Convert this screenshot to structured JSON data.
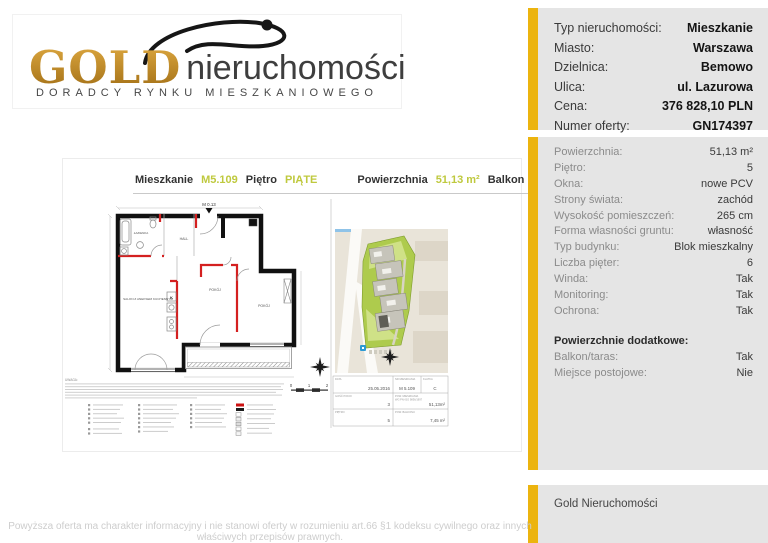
{
  "page": {
    "footer_disclaimer": "Powyższa oferta ma charakter informacyjny i nie stanowi oferty w rozumieniu art.66 §1 kodeksu cywilnego oraz innych właściwych przepisów prawnych."
  },
  "logo": {
    "brand_primary": "GOLD",
    "brand_secondary": "nieruchomości",
    "tagline": "DORADCY RYNKU MIESZKANIOWEGO"
  },
  "colors": {
    "accent_gold": "#ecb40f",
    "accent_lime": "#bfc93e",
    "panel_bg": "#e5e5e5",
    "wall_black": "#111111",
    "partition_red": "#d42020",
    "map_green": "#aecb4d",
    "map_beige": "#e9e4d9",
    "marker_blue": "#2d9ad4",
    "logo_gold": "#bb861d"
  },
  "plan_document": {
    "header": {
      "apartment_label": "Mieszkanie",
      "apartment_value": "M5.109",
      "floor_label": "Piętro",
      "floor_value": "PIĄTE",
      "area_label": "Powierzchnia",
      "area_value": "51,13 m²",
      "balcony_label": "Balkon",
      "balcony_value": "7,45 m²"
    },
    "entrance_label": "M 0.13",
    "rooms": {
      "bathroom": "ŁAZIENKA",
      "living": "SALON Z ANEKSEM KUCHENNYM",
      "hall": "HALL",
      "room_1": "POKÓJ",
      "room_2": "POKÓJ",
      "kitchen_symbol": "K"
    },
    "note_label": "UWAGA:",
    "scale_bar": {
      "tick_0": "0",
      "tick_1": "1",
      "tick_2": "2"
    },
    "title_block": {
      "date_label": "DATA",
      "date_value": "25.05.2016",
      "unit_label": "NR MIESZKANIA",
      "unit_value": "M 5.109",
      "staircase_label": "KLATKA",
      "staircase_value": "C",
      "rooms_label": "ILOŚĆ POKOI",
      "rooms_value": "3",
      "area_label": "POW. MIESZKANIA",
      "area_label_2": "WG PN-ISO 9836/1997",
      "area_value": "51,13m²",
      "floor_label": "PIĘTRO",
      "floor_value": "5",
      "balcony_label": "POW. BALKONU",
      "balcony_value": "7,45 m²"
    }
  },
  "sidebar": {
    "summary": {
      "rows": [
        {
          "label": "Typ nieruchomości:",
          "value": "Mieszkanie"
        },
        {
          "label": "Miasto:",
          "value": "Warszawa"
        },
        {
          "label": "Dzielnica:",
          "value": "Bemowo"
        },
        {
          "label": "Ulica:",
          "value": "ul. Lazurowa"
        },
        {
          "label": "Cena:",
          "value": "376 828,10 PLN"
        },
        {
          "label": "Numer oferty:",
          "value": "GN174397"
        }
      ]
    },
    "details": {
      "rows": [
        {
          "label": "Powierzchnia:",
          "value": "51,13 m²"
        },
        {
          "label": "Piętro:",
          "value": "5"
        },
        {
          "label": "Okna:",
          "value": "nowe PCV"
        },
        {
          "label": "Strony świata:",
          "value": "zachód"
        },
        {
          "label": "Wysokość pomieszczeń:",
          "value": "265 cm"
        },
        {
          "label": "Forma własności gruntu:",
          "value": "własność"
        },
        {
          "label": "Typ budynku:",
          "value": "Blok mieszkalny"
        },
        {
          "label": "Liczba pięter:",
          "value": "6"
        },
        {
          "label": "Winda:",
          "value": "Tak"
        },
        {
          "label": "Monitoring:",
          "value": "Tak"
        },
        {
          "label": "Ochrona:",
          "value": "Tak"
        }
      ]
    },
    "extras": {
      "heading": "Powierzchnie dodatkowe:",
      "rows": [
        {
          "label": "Balkon/taras:",
          "value": "Tak"
        },
        {
          "label": "Miejsce postojowe:",
          "value": "Nie"
        }
      ]
    },
    "agency": {
      "name": "Gold Nieruchomości"
    }
  }
}
